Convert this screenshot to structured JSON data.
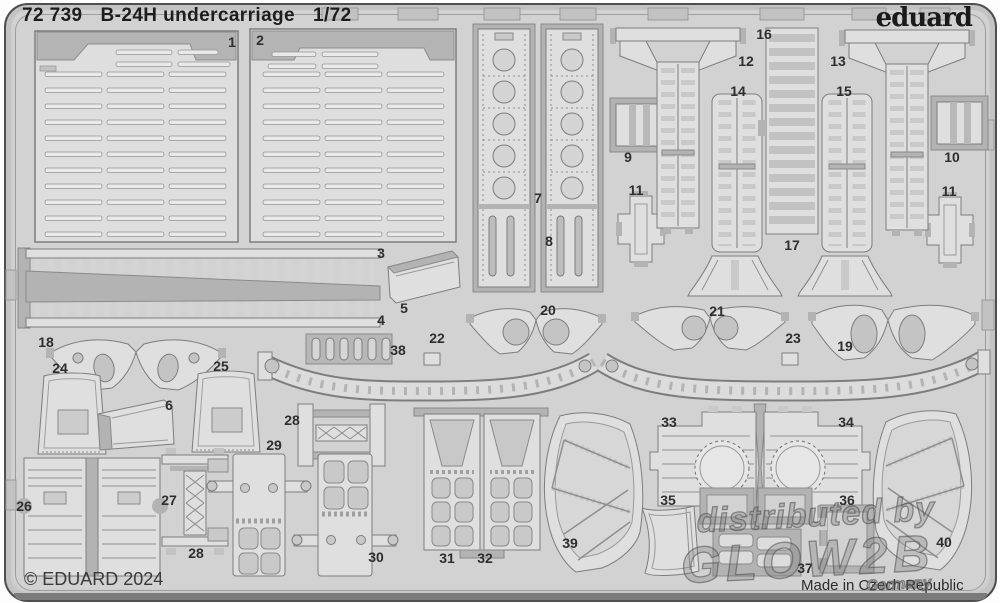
{
  "header": {
    "catalog_number": "72 739",
    "title": "B-24H undercarriage",
    "scale": "1/72",
    "brand": "eduard"
  },
  "footer": {
    "copyright": "© EDUARD 2024",
    "made_in": "Made in Czech Republic"
  },
  "watermark": {
    "line1": "distributed by",
    "line2": "GLOW2B",
    "line3": "Germany"
  },
  "colors": {
    "sheet_base": "#d2d2d2",
    "part_surface": "#dfdfdf",
    "half_etch_gray": "#b3b3b3",
    "outline_gray": "#7d7d7d",
    "text_dark": "#1d1d1d"
  },
  "parts": [
    {
      "num": "1",
      "x": 232,
      "y": 42
    },
    {
      "num": "2",
      "x": 260,
      "y": 40
    },
    {
      "num": "3",
      "x": 381,
      "y": 253
    },
    {
      "num": "4",
      "x": 381,
      "y": 320
    },
    {
      "num": "5",
      "x": 404,
      "y": 308
    },
    {
      "num": "6",
      "x": 169,
      "y": 405
    },
    {
      "num": "7",
      "x": 538,
      "y": 198
    },
    {
      "num": "8",
      "x": 549,
      "y": 241
    },
    {
      "num": "9",
      "x": 628,
      "y": 157
    },
    {
      "num": "10",
      "x": 952,
      "y": 157
    },
    {
      "num": "11",
      "x": 636,
      "y": 190
    },
    {
      "num": "11",
      "x": 949,
      "y": 191
    },
    {
      "num": "12",
      "x": 746,
      "y": 61
    },
    {
      "num": "13",
      "x": 838,
      "y": 61
    },
    {
      "num": "14",
      "x": 738,
      "y": 91
    },
    {
      "num": "15",
      "x": 844,
      "y": 91
    },
    {
      "num": "16",
      "x": 764,
      "y": 34
    },
    {
      "num": "17",
      "x": 792,
      "y": 245
    },
    {
      "num": "18",
      "x": 46,
      "y": 342
    },
    {
      "num": "19",
      "x": 845,
      "y": 346
    },
    {
      "num": "20",
      "x": 548,
      "y": 310
    },
    {
      "num": "21",
      "x": 717,
      "y": 311
    },
    {
      "num": "22",
      "x": 437,
      "y": 338
    },
    {
      "num": "23",
      "x": 793,
      "y": 338
    },
    {
      "num": "24",
      "x": 60,
      "y": 368
    },
    {
      "num": "25",
      "x": 221,
      "y": 366
    },
    {
      "num": "26",
      "x": 24,
      "y": 506
    },
    {
      "num": "27",
      "x": 169,
      "y": 500
    },
    {
      "num": "28",
      "x": 292,
      "y": 420
    },
    {
      "num": "28",
      "x": 196,
      "y": 553
    },
    {
      "num": "29",
      "x": 274,
      "y": 445
    },
    {
      "num": "30",
      "x": 376,
      "y": 557
    },
    {
      "num": "31",
      "x": 447,
      "y": 558
    },
    {
      "num": "32",
      "x": 485,
      "y": 558
    },
    {
      "num": "33",
      "x": 669,
      "y": 422
    },
    {
      "num": "34",
      "x": 846,
      "y": 422
    },
    {
      "num": "35",
      "x": 668,
      "y": 500
    },
    {
      "num": "36",
      "x": 847,
      "y": 500
    },
    {
      "num": "37",
      "x": 805,
      "y": 568
    },
    {
      "num": "38",
      "x": 398,
      "y": 350
    },
    {
      "num": "39",
      "x": 570,
      "y": 543
    },
    {
      "num": "40",
      "x": 944,
      "y": 542
    }
  ]
}
